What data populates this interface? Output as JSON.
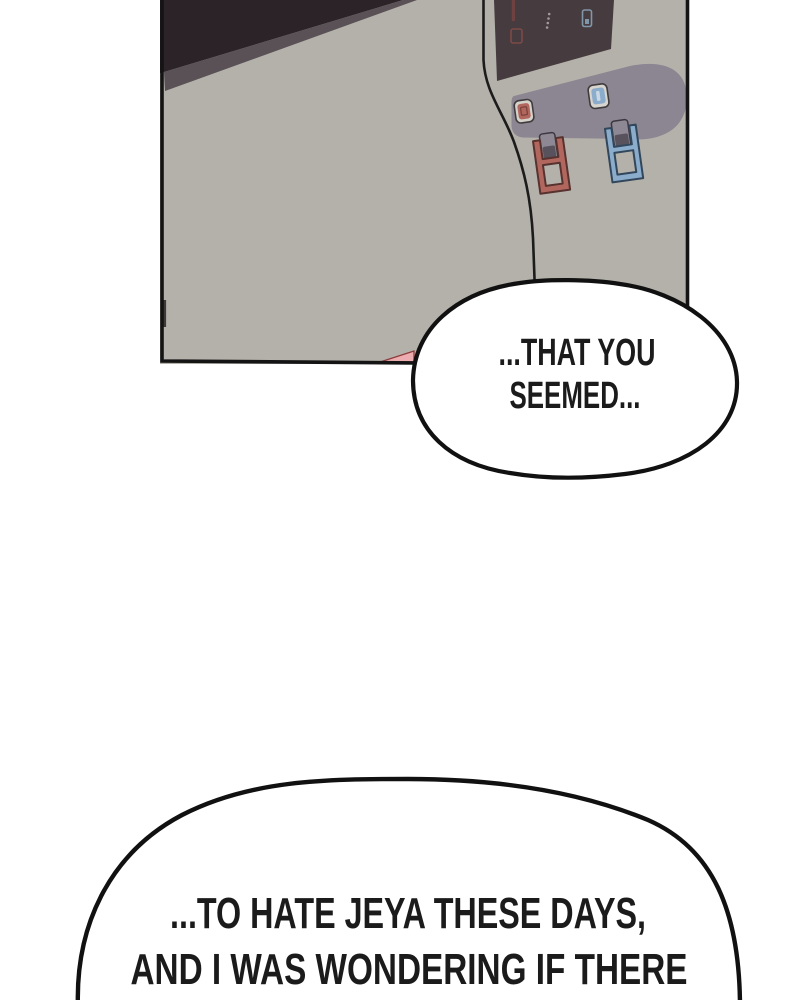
{
  "colors": {
    "background": "#ffffff",
    "outline": "#141414",
    "panel_body": "#b4b1aa",
    "panel_recess": "#8b8691",
    "screen_dark": "#463b3f",
    "top_shadow": "#2b2327",
    "top_shadow_edge": "#595156",
    "hot_accent": "#b2675e",
    "hot_outline": "#57322f",
    "cold_accent": "#8caccb",
    "cold_outline": "#31475c",
    "button_ring": "#d5d2cb",
    "spout_gray": "#8d8893",
    "spout_gray_dark": "#57525c",
    "splash_pink": "#edadb0",
    "bubble_fill": "#ffffff"
  },
  "speech_bubbles": [
    {
      "lines": [
        "...THAT YOU",
        "SEEMED..."
      ]
    },
    {
      "lines": [
        "...TO HATE JEYA THESE DAYS,",
        "AND I WAS WONDERING IF THERE"
      ]
    }
  ]
}
